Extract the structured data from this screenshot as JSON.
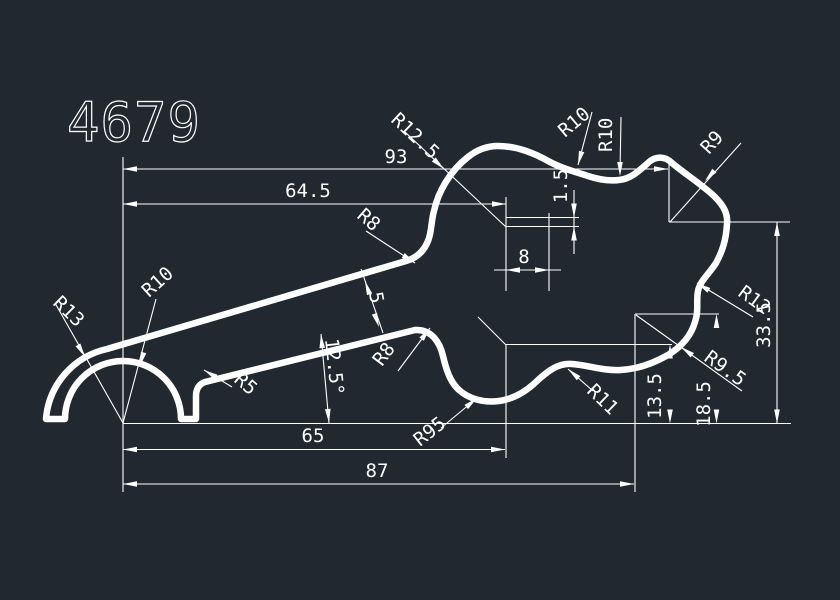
{
  "canvas": {
    "background": "#212830",
    "line_color": "#ffffff"
  },
  "title_block": {
    "drawing_number": "4679"
  },
  "labels": {
    "dim_93": "93",
    "dim_64_5": "64.5",
    "dim_8": "8",
    "dim_1_5": "1.5",
    "dim_33_5": "33.5",
    "dim_18_5": "18.5",
    "dim_13_5": "13.5",
    "dim_65": "65",
    "dim_87": "87",
    "dim_angle_12_5": "12.5°",
    "dim_thickness_5": "5",
    "r12_5": "R12.5",
    "r10_upper": "R10",
    "r10_mid": "R10",
    "r9": "R9",
    "r12": "R12",
    "r9_5": "R9.5",
    "r11": "R11",
    "r95": "R95",
    "r8_upper": "R8",
    "r8_lower": "R8",
    "r13": "R13",
    "r10_arch": "R10",
    "r5": "R5"
  }
}
